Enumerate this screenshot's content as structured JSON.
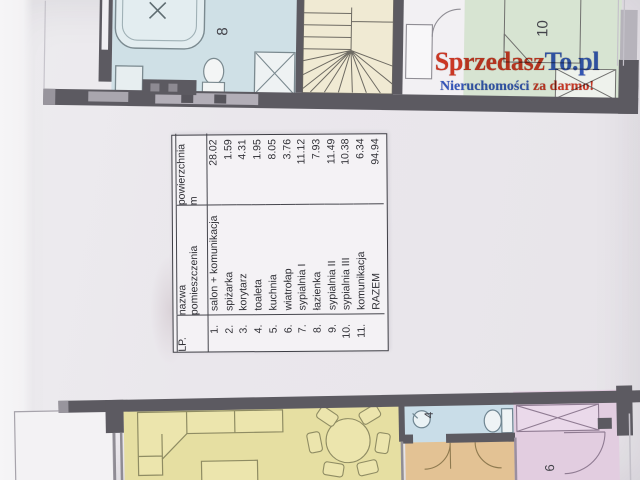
{
  "watermark": {
    "brand_part1": "Sprzedasz",
    "brand_part2": "To.pl",
    "tagline_part1": "Nieruchomości",
    "tagline_part2": "za darmo!"
  },
  "room_table": {
    "header": {
      "lp": "LP.",
      "name_line1": "nazwa",
      "name_line2": "pomieszczenia",
      "area_line1": "powierzchnia",
      "area_line2": "m"
    },
    "rows": [
      {
        "lp": "1.",
        "name": "salon + komunikacja",
        "area": "28.02"
      },
      {
        "lp": "2.",
        "name": "spiżarka",
        "area": "1.59"
      },
      {
        "lp": "3.",
        "name": "korytarz",
        "area": "4.31"
      },
      {
        "lp": "4.",
        "name": "toaleta",
        "area": "1.95"
      },
      {
        "lp": "5.",
        "name": "kuchnia",
        "area": "8.05"
      },
      {
        "lp": "6.",
        "name": "wiatrołap",
        "area": "3.76"
      },
      {
        "lp": "7.",
        "name": "sypialnia I",
        "area": "11.12"
      },
      {
        "lp": "8.",
        "name": "łazienka",
        "area": "7.93"
      },
      {
        "lp": "9.",
        "name": "sypialnia II",
        "area": "11.49"
      },
      {
        "lp": "10.",
        "name": "sypialnia III",
        "area": "10.38"
      },
      {
        "lp": "11.",
        "name": "komunikacja",
        "area": "6.34"
      },
      {
        "lp": "",
        "name": "RAZEM",
        "area": "94.94"
      }
    ]
  },
  "floor_plan_upper": {
    "bathroom_number": "8",
    "bedroom_number": "10"
  },
  "floor_plan_lower": {
    "toilet_number": "4",
    "bedroom_number": "6"
  },
  "colors": {
    "watermark_red": "#d4321c",
    "watermark_blue": "#2d53c0",
    "wall": "#5c5a61",
    "bathroom_fill": "#cfe0e6",
    "stairs_fill": "#f0ead3",
    "bedroom_upper_fill": "#d7e4d2",
    "living_room_fill": "#e6dfa2",
    "toilet_fill": "#c9dde8",
    "hallway_fill": "#e3c294",
    "bedroom_lower_fill": "#e2cde0"
  }
}
